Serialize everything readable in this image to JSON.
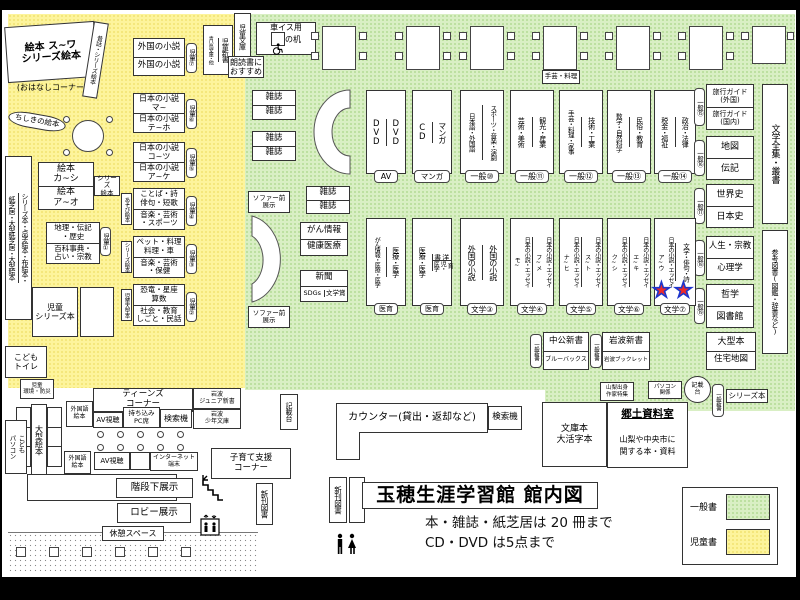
{
  "colors": {
    "green": "#d9efc4",
    "yellow": "#fdf49c",
    "pink": "#f49ac1",
    "star_fill": "#ee2b2b",
    "star_outline": "#1d35cc"
  },
  "tb": {
    "t": "玉穂生涯学習館 館内図",
    "n1": "本・雑誌・紙芝居は 20 冊まで",
    "n2": "CD・DVD は5点まで"
  },
  "lg": {
    "general": "一般書",
    "children": "児童書"
  },
  "ca": {
    "big": "絵本 ス~ワ\nシリーズ絵本",
    "ohanashi": "(おはなしコーナー)",
    "mukashi": "昔話・シリーズ絵本",
    "chishiki": "ちしきの絵本",
    "strip_left": "紙芝居・大型紙芝居・大型絵本",
    "strip_right": "シリーズ本・点字絵本・布絵本・",
    "aoitori": "青い鳥文庫・他",
    "jshinsho": "児童新書",
    "jbunko": "児童文庫",
    "roudoku": "朗読書に\nおすすめ",
    "s7": {
      "r1": "外国の小説",
      "r2": "外国の小説",
      "tag": "児童⑦"
    },
    "s6": {
      "r1": "日本の小説\nマ~",
      "r2": "日本の小説\nテ~ホ",
      "tag": "児童⑥"
    },
    "s5": {
      "r1": "日本の小説\nコ~ツ",
      "r2": "日本の小説\nア~ケ",
      "tag": "児童⑤"
    },
    "s4": {
      "r1": "ことば・詩\n俳句・短歌",
      "r2": "音楽・芸術\n・スポーツ",
      "tag": "児童④",
      "side": "あそび絵本"
    },
    "s3": {
      "r1": "ペット・料理\n料理・車",
      "r2": "音楽・芸術\n・保健",
      "tag": "児童③",
      "side": "シリーズ絵本"
    },
    "s2": {
      "r1": "恐竜・星座\n算数",
      "r2": "社会・教育\nしごと・民話",
      "tag": "児童②",
      "side": "児童大型本"
    },
    "ehon": {
      "r1": "絵本\nカ~シ",
      "r2": "絵本\nア~オ",
      "side": "シリーズ\n絵本"
    },
    "s1": {
      "r1": "地理・伝記\n・歴史",
      "r2": "百科事典・\n占い・宗教",
      "tag": "児童①"
    },
    "jseries": "児童\nシリーズ本",
    "toilet": "こども\nトイレ",
    "kankyo": "児童\n環境・防災",
    "ogata": "大型絵本",
    "kidspc": "こども\nパソコン"
  },
  "ga": {
    "wdesk1": "車イス用",
    "wdesk2": "の机",
    "mag": "雑誌",
    "sofa": "ソファー前\n展示",
    "gan1": "がん情報",
    "gan2": "健康医療",
    "np": "新聞",
    "sdgs": "SDGs",
    "bunsho": "文学賞",
    "craft": "手芸・料理",
    "row1": [
      {
        "c1": "DVD",
        "c2": "DVD",
        "label": "AV"
      },
      {
        "c1": "CD",
        "c2": "マンガ",
        "label": "マンガ"
      },
      {
        "c1": "日本語・外国語",
        "c2": "スポーツ・音楽・演劇",
        "label": "一般⑩"
      },
      {
        "c1": "芸術・美術",
        "c2": "観光・産業",
        "label": "一般⑪"
      },
      {
        "c1": "手芸・料理・家事",
        "c2": "技術・工業",
        "label": "一般⑫"
      },
      {
        "c1": "数学・自然科学",
        "c2": "民俗・教育",
        "label": "一般⑬"
      },
      {
        "c1": "税金・福祉",
        "c2": "政治・法律",
        "label": "一般⑭"
      }
    ],
    "row2": [
      {
        "c1": "がん情報・医療・医学",
        "c2": "医療・医学",
        "label": "医育"
      },
      {
        "c1": "医療・医学",
        "c2a": "洋書",
        "c2b": "育児・医学",
        "label": "医育"
      },
      {
        "c1": "外国の小説",
        "c2": "外国の小説",
        "label": "文学③"
      },
      {
        "c1": "日本の小説・エッセイ\nモ~",
        "c2": "日本の小説・エッセイ\nフ~メ",
        "label": "文学④"
      },
      {
        "c1": "日本の小説・エッセイ\nナ~ヒ",
        "c2": "日本の小説・エッセイ\nス~ト",
        "label": "文学⑤"
      },
      {
        "c1": "日本の小説・エッセイ\nク~シ",
        "c2": "日本の小説・エッセイ\nエ~キ",
        "label": "文学⑥"
      },
      {
        "c1": "日本の小説・エッセイ\nア~ウ",
        "c2": "文学・俳句・詩",
        "label": "文学⑦"
      }
    ],
    "right": [
      {
        "r1": "旅行ガイド\n(外国)",
        "r2": "旅行ガイド\n(国内)",
        "tag": "一般⑮"
      },
      {
        "r1": "地図",
        "r2": "伝記",
        "tag": "一般⑯"
      },
      {
        "r1": "世界史",
        "r2": "日本史",
        "tag": "一般⑰"
      },
      {
        "r1": "人生・宗教",
        "r2": "心理学",
        "tag": "一般⑱"
      },
      {
        "r1": "哲学",
        "r2": "図書館",
        "tag": "一般⑲"
      }
    ],
    "zenshu": "文学全集・叢書",
    "sanko": "参考図書(図鑑・辞書など)",
    "shinsho1": {
      "r1": "中公新書",
      "r2": "ブルーバックス",
      "tag": "一般新書"
    },
    "shinsho2": {
      "r1": "岩波新書",
      "r2": "岩波ブックレット",
      "tag": "一般新書"
    },
    "ogata": {
      "r1": "大型本",
      "r2": "住宅地図"
    },
    "yamanashi": "山梨出身\n作家特集",
    "pckankei": "パソコン\n関係",
    "kisaidai": "記載\n台",
    "ippan": "一般新書",
    "series": "シリーズ本",
    "star": "★"
  },
  "ba": {
    "kisaidai2": "記載台",
    "counter": "カウンター(貸出・返却など)",
    "kensaku1": "検索機",
    "kensaku2": "検索機",
    "bunko": "文庫本\n大活字本",
    "kyodo_t": "郷土資料室",
    "kyodo_d": "山梨や中央市に\n関する本・資料",
    "teens": "ティーンズ\nコーナー",
    "ij": "岩波\nジュニア新書",
    "is": "岩波\n少年文庫",
    "gaikokugo1": "外国語\n絵本",
    "gaikokugo2": "外国語\n絵本",
    "av1": "AV視聴",
    "av2": "AV視聴",
    "pc": "持ち込み\nPC席",
    "internet": "インターネット\n端末",
    "kosodate": "子育て支援\nコーナー",
    "kaidan": "階段下展示",
    "lobby": "ロビー展示",
    "rest": "休憩スペース",
    "shinkan1": "新刊図書",
    "shinkan2": "新刊図書"
  }
}
